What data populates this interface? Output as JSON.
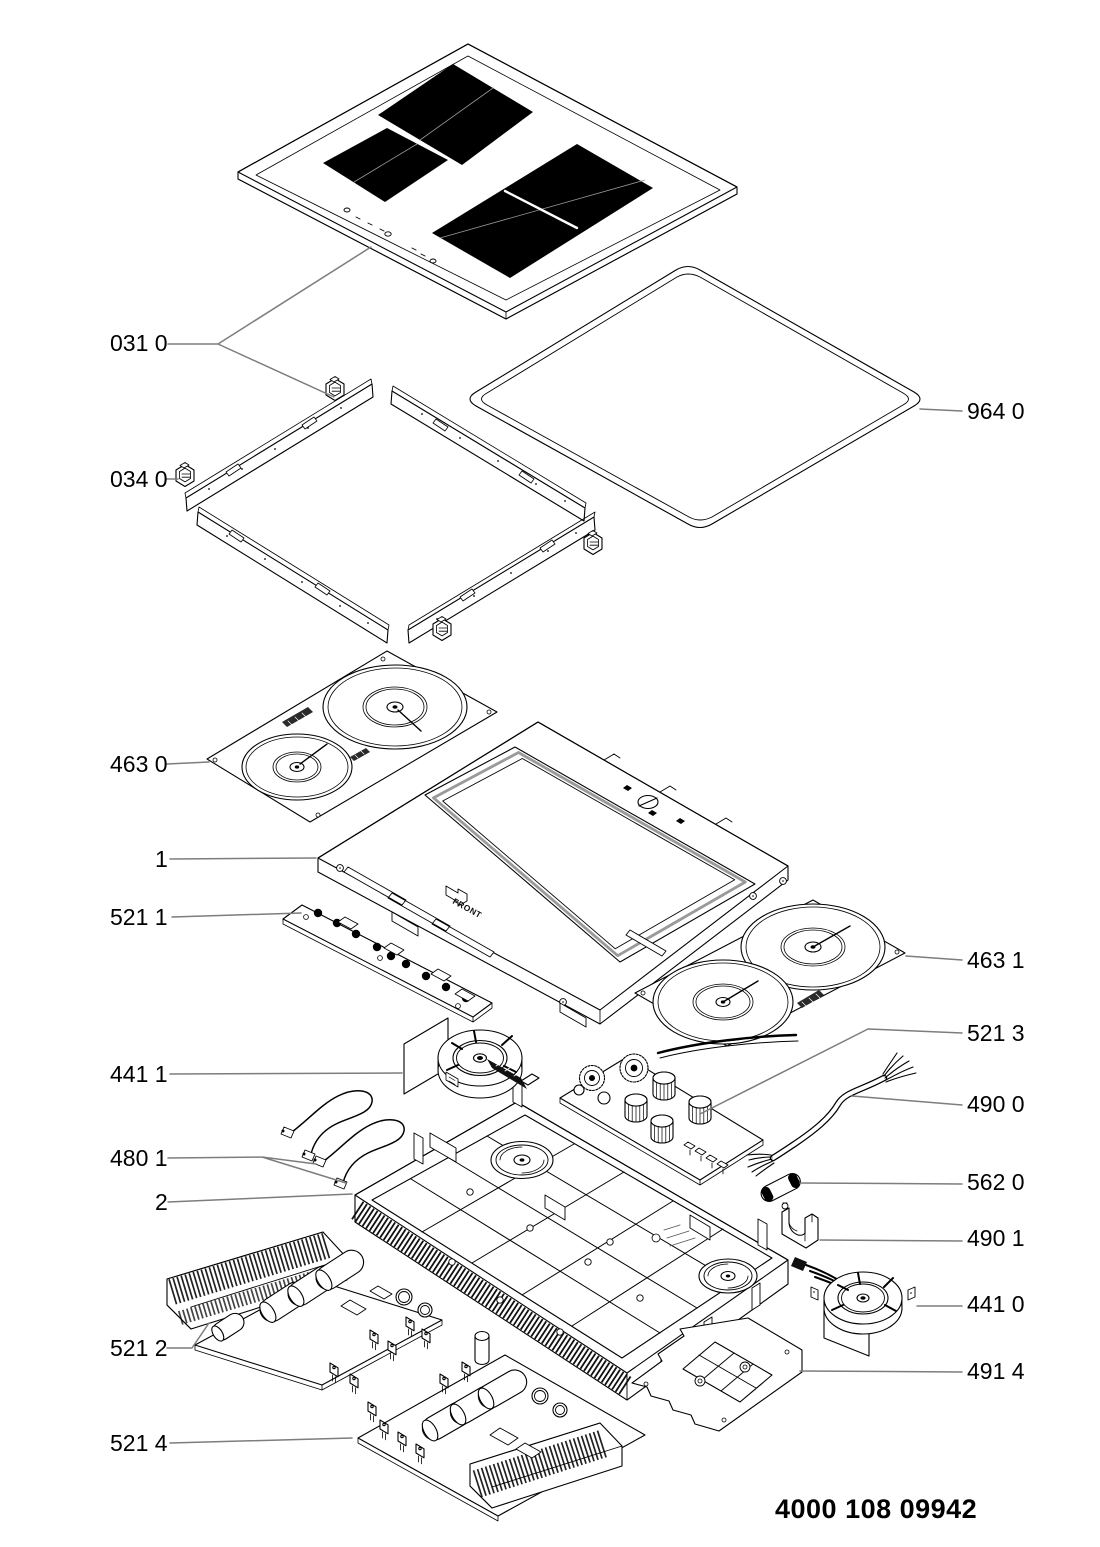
{
  "document": {
    "doc_number": "4000 108 09942"
  },
  "annotations": {
    "front_marking": "FRONT"
  },
  "colors": {
    "line": "#000000",
    "leader": "#7d7d7d",
    "zone_fill": "#000000",
    "background": "#ffffff"
  },
  "parts": [
    {
      "id": "031-0",
      "label": "031 0"
    },
    {
      "id": "034-0",
      "label": "034 0"
    },
    {
      "id": "964-0",
      "label": "964 0"
    },
    {
      "id": "463-0",
      "label": "463 0"
    },
    {
      "id": "1",
      "label": "1"
    },
    {
      "id": "521-1",
      "label": "521 1"
    },
    {
      "id": "463-1",
      "label": "463 1"
    },
    {
      "id": "521-3",
      "label": "521 3"
    },
    {
      "id": "441-1",
      "label": "441 1"
    },
    {
      "id": "490-0",
      "label": "490 0"
    },
    {
      "id": "480-1",
      "label": "480 1"
    },
    {
      "id": "562-0",
      "label": "562 0"
    },
    {
      "id": "2",
      "label": "2"
    },
    {
      "id": "490-1",
      "label": "490 1"
    },
    {
      "id": "441-0",
      "label": "441 0"
    },
    {
      "id": "521-2",
      "label": "521 2"
    },
    {
      "id": "491-4",
      "label": "491 4"
    },
    {
      "id": "521-4",
      "label": "521 4"
    }
  ]
}
